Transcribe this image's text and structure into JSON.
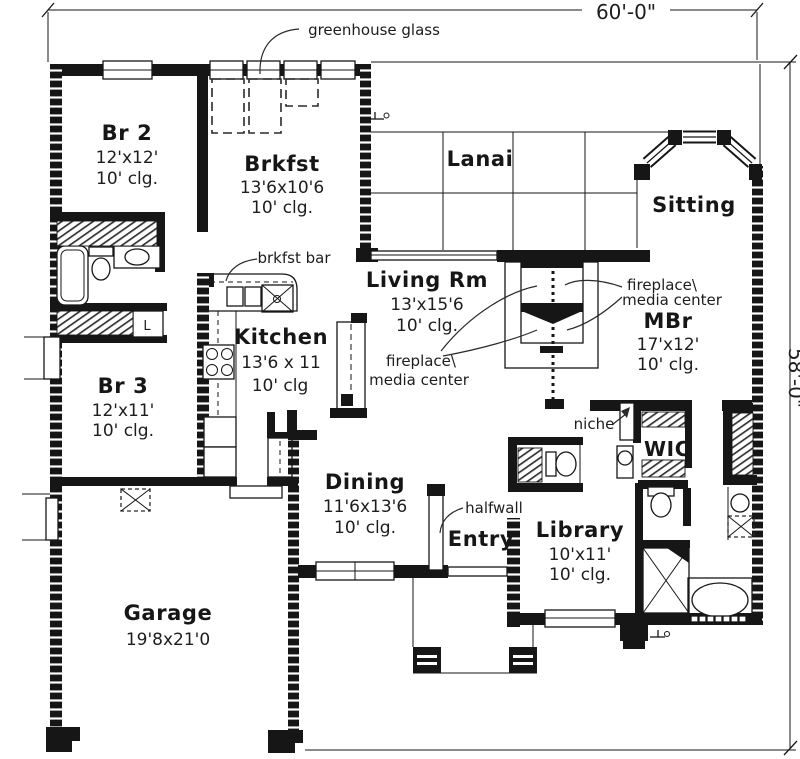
{
  "dims": {
    "top": "60'-0\"",
    "right": "58'-0\""
  },
  "annotations": {
    "greenhouse": "greenhouse glass",
    "brkfst_bar": "brkfst bar",
    "fp1": "fireplace\\",
    "fp2": "media center",
    "niche": "niche",
    "halfwall": "halfwall",
    "linen": "L"
  },
  "rooms": {
    "br2": {
      "name": "Br 2",
      "size": "12'x12'",
      "clg": "10' clg."
    },
    "brkfst": {
      "name": "Brkfst",
      "size": "13'6x10'6",
      "clg": "10' clg."
    },
    "lanai": {
      "name": "Lanai"
    },
    "sitting": {
      "name": "Sitting"
    },
    "living": {
      "name": "Living Rm",
      "size": "13'x15'6",
      "clg": "10' clg."
    },
    "mbr": {
      "name": "MBr",
      "size": "17'x12'",
      "clg": "10' clg."
    },
    "kitchen": {
      "name": "Kitchen",
      "size": "13'6 x 11",
      "clg": "10' clg"
    },
    "br3": {
      "name": "Br 3",
      "size": "12'x11'",
      "clg": "10' clg."
    },
    "dining": {
      "name": "Dining",
      "size": "11'6x13'6",
      "clg": "10' clg."
    },
    "entry": {
      "name": "Entry"
    },
    "library": {
      "name": "Library",
      "size": "10'x11'",
      "clg": "10' clg."
    },
    "wic": {
      "name": "WIC"
    },
    "garage": {
      "name": "Garage",
      "size": "19'8x21'0"
    }
  }
}
